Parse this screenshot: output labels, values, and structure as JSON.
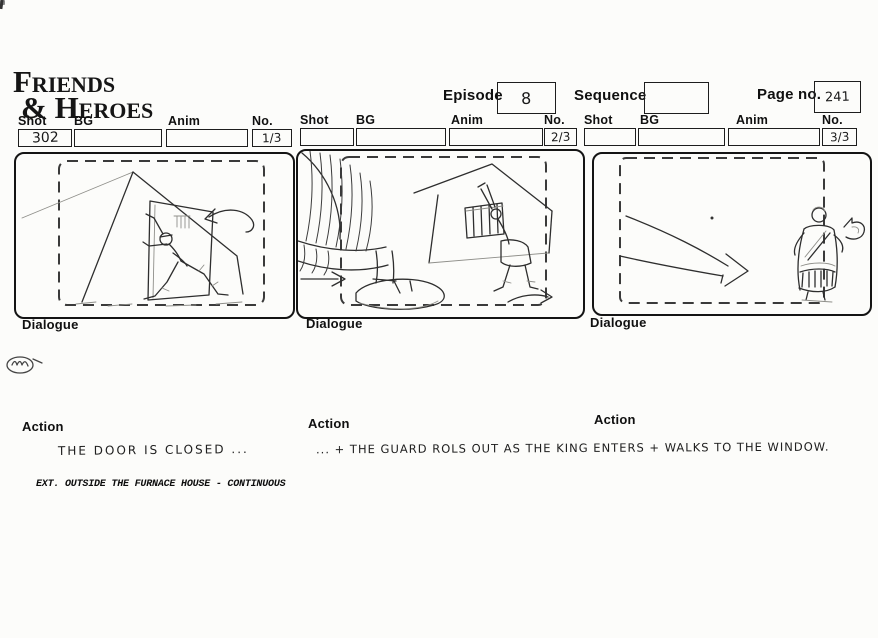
{
  "colors": {
    "paper": "#fcfcfa",
    "ink": "#1b1b1b",
    "pencil": "#2e2e2e"
  },
  "logo": {
    "line1": "Friends",
    "line2": "& Heroes"
  },
  "labels": {
    "shot": "Shot",
    "bg": "BG",
    "anim": "Anim",
    "no": "No.",
    "episode": "Episode",
    "sequence": "Sequence",
    "page_no": "Page no.",
    "dialogue": "Dialogue",
    "action": "Action"
  },
  "header": {
    "episode": "8",
    "sequence": "",
    "page_no": "241"
  },
  "columns": [
    {
      "shot": "302",
      "bg": "",
      "anim": "",
      "no": "1/3",
      "action_text": "THE DOOR IS CLOSED ...",
      "scene_heading": "EXT. OUTSIDE THE FURNACE HOUSE - CONTINUOUS",
      "sketch_alt": "Guard pulls the furnace house door closed; curved arrow shows the door swinging shut"
    },
    {
      "shot": "",
      "bg": "",
      "anim": "",
      "no": "2/3",
      "action_text": "... + THE GUARD ROLS OUT AS THE KING ENTERS + WALKS TO THE WINDOW.",
      "scene_heading": "",
      "sketch_alt": "Close-up of the king's robe and sandalled foot entering frame; guard dashes right past the furnace house window; motion arrows left and right"
    },
    {
      "shot": "",
      "bg": "",
      "anim": "",
      "no": "3/3",
      "action_text": "",
      "scene_heading": "",
      "sketch_alt": "Large motion arrow sweeps toward the king, seen from behind at the window; small turn arrow beside him"
    }
  ]
}
